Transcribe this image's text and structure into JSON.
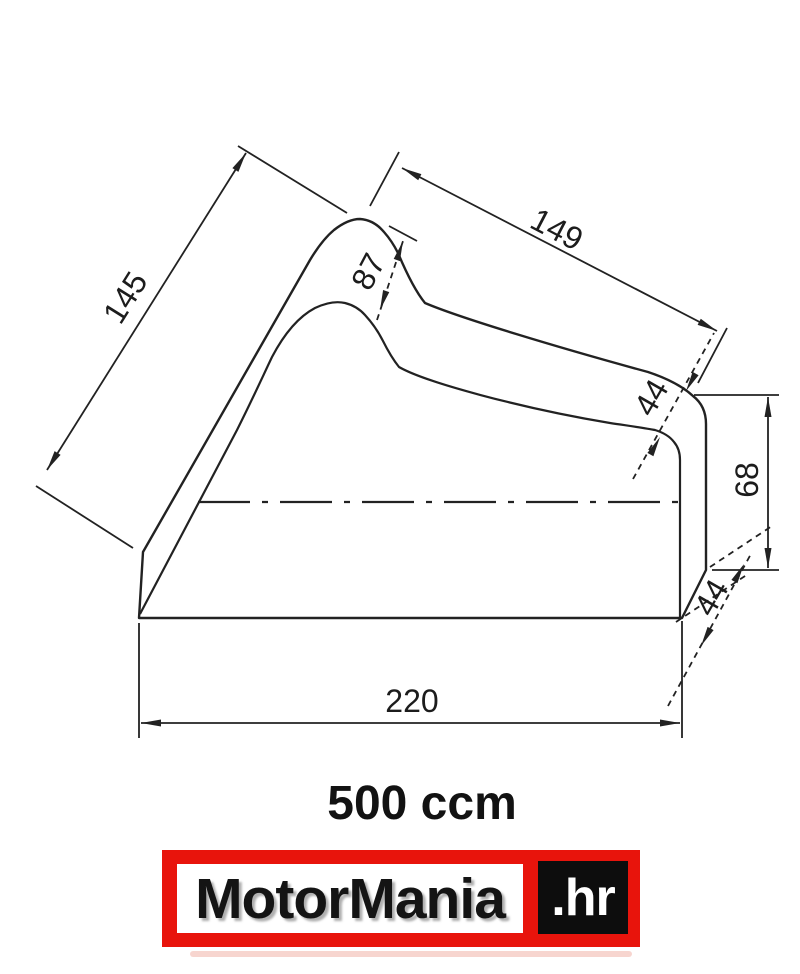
{
  "page": {
    "background": "#ffffff"
  },
  "drawing": {
    "type": "technical-diagram",
    "subject": "motorcycle cover side profile with dimension callouts",
    "line_color": "#222222",
    "dimensions": {
      "front_slant": "145",
      "top_slant": "149",
      "handlebar_hump": "87",
      "tail_edge": "44",
      "rear_height": "68",
      "rear_bottom_edge": "44",
      "base_length": "220"
    }
  },
  "caption": {
    "text": "500 ccm"
  },
  "logo": {
    "brand": "MotorMania",
    "suffix": ".hr",
    "frame_color": "#e8140c",
    "brand_text_color": "#141414",
    "suffix_bg_color": "#0d0d0d",
    "suffix_text_color": "#ffffff"
  }
}
